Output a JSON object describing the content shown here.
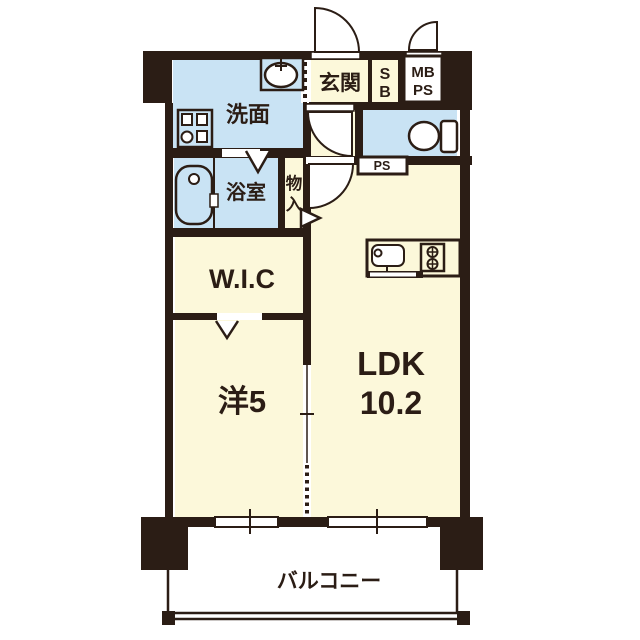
{
  "plan": {
    "type": "apartment-floor-plan",
    "colors": {
      "wall": "#2b1d15",
      "floor_cream": "#fcf8da",
      "wet_area_blue": "#c9e3f4",
      "fixture_white": "#ffffff"
    },
    "rooms": {
      "washroom": {
        "label": "洗面"
      },
      "entrance": {
        "label": "玄関"
      },
      "shoebox": {
        "line1": "S",
        "line2": "B"
      },
      "meterbox": {
        "line1": "MB",
        "line2": "PS"
      },
      "toilet": {
        "label": ""
      },
      "pipespace": {
        "label": "PS"
      },
      "bathroom": {
        "label": "浴室"
      },
      "storage": {
        "line1": "物",
        "line2": "入"
      },
      "wic": {
        "label": "W.I.C"
      },
      "western": {
        "label": "洋5"
      },
      "ldk": {
        "line1": "LDK",
        "line2": "10.2"
      },
      "balcony": {
        "label": "バルコニー"
      }
    },
    "icons": [
      "bathtub-icon",
      "washing-machine-icon",
      "sink-icon",
      "toilet-icon",
      "kitchen-sink-icon",
      "stove-icon",
      "entrance-door-arc",
      "meterbox-door-arc",
      "hall-door-arc",
      "ldk-door-arc",
      "folding-door-mark",
      "sliding-door-mark",
      "accordion-door-mark",
      "storage-door-triangle",
      "sliding-window",
      "balcony-railing"
    ]
  }
}
